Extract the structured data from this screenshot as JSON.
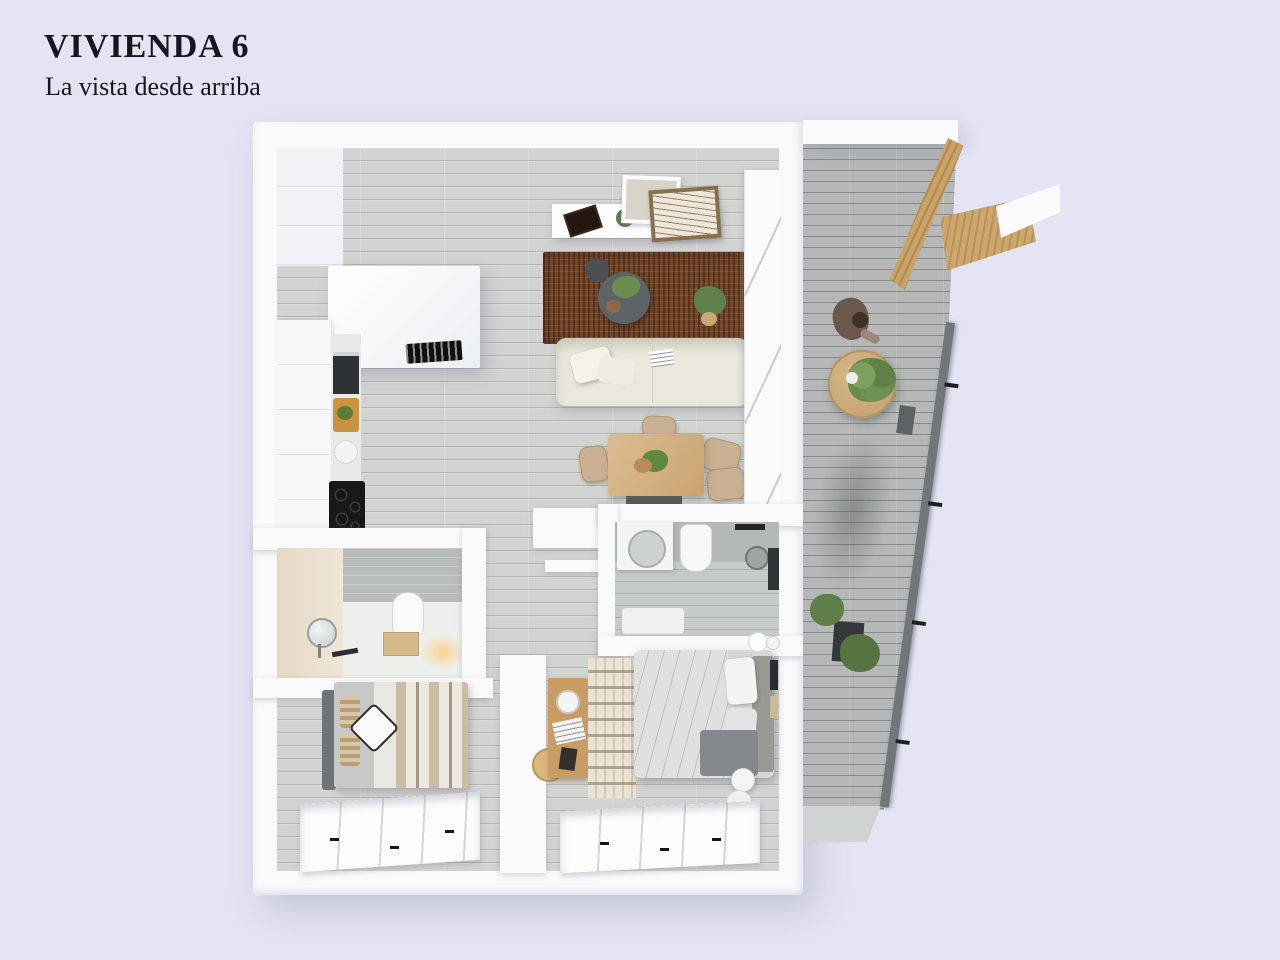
{
  "header": {
    "title": "VIVIENDA 6",
    "subtitle": "La vista desde arriba"
  },
  "palette": {
    "background": "#e4e4f4",
    "title_text": "#16161f",
    "wall": "#fafafc",
    "floor": "#d2d4d2",
    "balcony_floor": "#b5b8b7",
    "rug": "#74462a",
    "sofa": "#eae7dc",
    "wood": "#d2b184"
  }
}
